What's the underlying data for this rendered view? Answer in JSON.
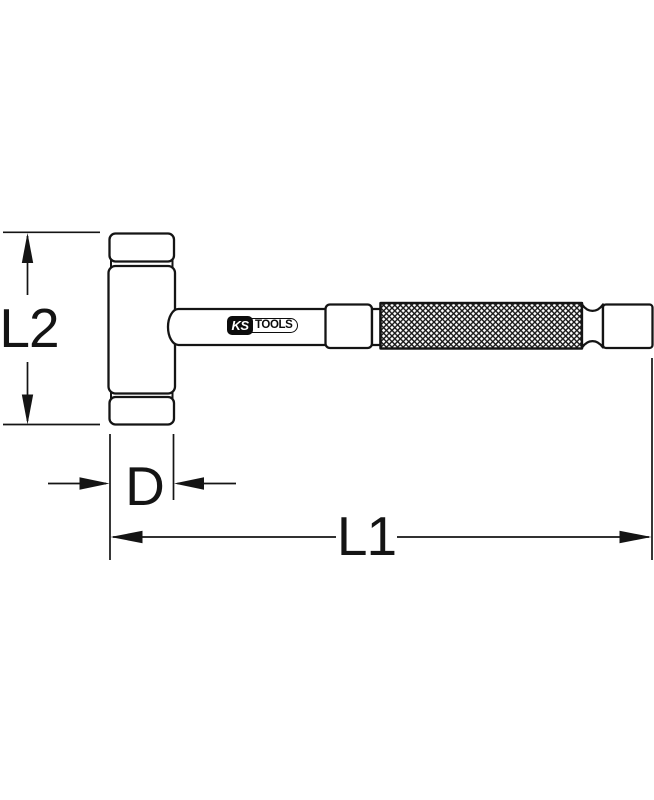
{
  "page": {
    "background_color": "#ffffff",
    "line_color": "#141414"
  },
  "diagram": {
    "type": "technical-line-drawing",
    "subject": "soft-faced hammer with knurled grip, side view with dimension callouts",
    "dimensions": [
      {
        "label": "L2",
        "orientation": "vertical",
        "measures": "head height"
      },
      {
        "label": "D",
        "orientation": "horizontal",
        "measures": "head diameter"
      },
      {
        "label": "L1",
        "orientation": "horizontal",
        "measures": "overall length"
      }
    ],
    "logo": {
      "ks": "KS",
      "tools": "TOOLS"
    }
  }
}
